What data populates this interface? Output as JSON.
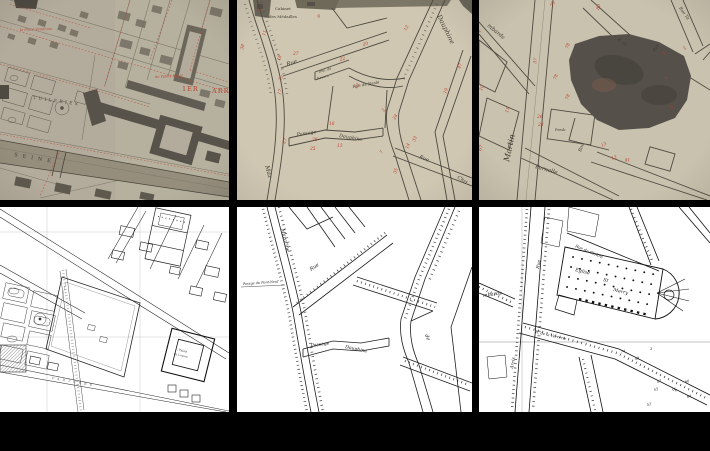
{
  "canvas": {
    "width": 710,
    "height": 451,
    "frame_color": "#000000"
  },
  "grid": {
    "rows": 2,
    "cols": 3
  },
  "panels": {
    "top_left": {
      "alt": "sepia engraved map - Tuileries, Louvre and Seine, 1st arrondissement",
      "colors": {
        "paper": "#b3ac9c",
        "ink": "#57524a",
        "overlay_red": "#bf4430",
        "river": "#958e7d"
      },
      "labels": {
        "arr_num": "1ER",
        "arr_word": "ARR",
        "river": "SEINE",
        "garden": "TUILERIES",
        "vendome": "la Place Vendôme",
        "palais_royal": "du Palais Royal"
      }
    },
    "top_middle": {
      "alt": "sepia street map - Rue Dauphine quarter with red house numbers",
      "colors": {
        "paper": "#cfc7b2",
        "ink": "#4d4940",
        "number_red": "#bf3e2a"
      },
      "labels": {
        "cabinet_line1": "Cabinet",
        "cabinet_line2": "des Médailles",
        "rue": "Rue",
        "imp_line1": "Imp. de",
        "imp_line2": "Nevers",
        "nesle": "Rue de Nesle",
        "dauphine": "Dauphine",
        "passage": "Passage",
        "passage_dauphine": "Dauphine",
        "rue_christine": "Rue",
        "christine": "Chri",
        "mazarine": "Maz"
      },
      "numbers": [
        "5",
        "11",
        "38",
        "18",
        "27",
        "6",
        "22",
        "20",
        "12",
        "35",
        "17",
        "13",
        "16",
        "2",
        "26",
        "25",
        "13",
        "27",
        "7",
        "35",
        "14",
        "33",
        "19",
        "47",
        "24"
      ]
    },
    "top_right": {
      "alt": "sepia street map - Saint-Merri block with dark stamped church",
      "colors": {
        "paper": "#c9c2ae",
        "ink": "#4f4a42",
        "church": "#55504a",
        "number_red": "#bf3e2a"
      },
      "labels": {
        "martin": "Martin",
        "lombards": "mbards",
        "pernelle": "Pernelle",
        "presbytere": "Presb",
        "r_du": "R. du",
        "rue": "Rue",
        "rue_ta": "Rue Ta",
        "bou": "Bou"
      },
      "numbers": [
        "79",
        "80",
        "78",
        "78",
        "78",
        "37",
        "26",
        "28",
        "10",
        "11",
        "67",
        "13",
        "12",
        "91",
        "5",
        "2",
        "1",
        "2",
        "4"
      ]
    },
    "bottom_left": {
      "alt": "black and white survey map - Tuileries gardens and Louvre",
      "colors": {
        "paper": "#ffffff",
        "ink": "#2b2b2b"
      },
      "labels": {
        "parterre": "PARTERRE",
        "palais_line1": "Palais",
        "palais_line2": "du Louvre"
      }
    },
    "bottom_middle": {
      "alt": "black and white cadastral map - Rue Dauphine quarter",
      "colors": {
        "paper": "#ffffff",
        "ink": "#1f1f1f"
      },
      "labels": {
        "mazarine": "Mazarine",
        "rue": "Rue",
        "de": "de",
        "passage": "Passage",
        "dauphine": "Dauphine",
        "pont_neuf": "Passge du Pont-Neuf"
      }
    },
    "bottom_right": {
      "alt": "black and white cadastral map - Eglise Saint-Merry",
      "colors": {
        "paper": "#ffffff",
        "ink": "#111111"
      },
      "labels": {
        "eglise": "Eglise",
        "st": "St",
        "merry": "Merry",
        "cloitre": "Rue du Cloître",
        "verrerie": "R. de la Verrerie",
        "lombards": "mbards",
        "rue": "Rue",
        "arcis": "Arcis",
        "de": "de"
      },
      "numbers": [
        "74",
        "49",
        "3",
        "57",
        "55",
        "53",
        "66",
        "64"
      ]
    }
  }
}
